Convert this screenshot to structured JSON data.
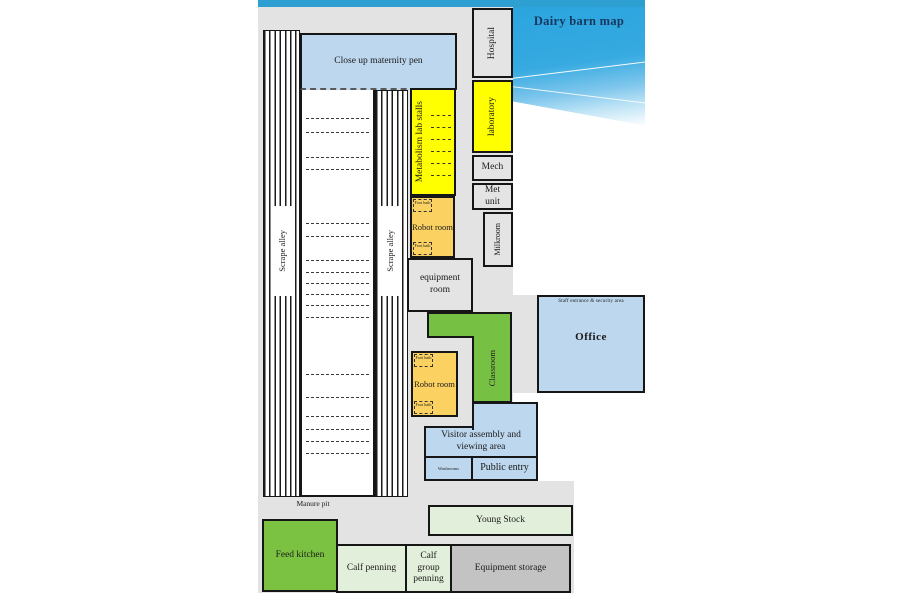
{
  "title": "Dairy barn map",
  "colors": {
    "header_bar": "#2d9fd0",
    "header_gradient": "#2ba4de",
    "title_text": "#17375e",
    "room_blue": "#bdd7ee",
    "room_yellow": "#ffff00",
    "room_orange": "#fbd262",
    "room_green": "#76c143",
    "room_pale_green": "#e2efda",
    "room_grey": "#e3e3e3",
    "room_dark_grey": "#c3c3c3"
  },
  "rooms": {
    "close_up_maternity_pen": "Close up maternity pen",
    "scrape_alley": "Scrape alley",
    "metabolism_lab_stalls": "Metabolism lab stalls",
    "hospital": "Hospital",
    "laboratory": "laboratory",
    "mech": "Mech",
    "met_unit": "Met unit",
    "milkroom": "Milkroom",
    "robot_room": "Robot room",
    "foot_bath": "Foot bath",
    "equipment_room": "equipment room",
    "classroom": "Classroom",
    "office": "Office",
    "staff_entrance": "Staff entrance & security area",
    "visitor_assembly": "Visitor assembly and viewing area",
    "washrooms": "Washrooms",
    "public_entry": "Public entry",
    "manure_pit": "Manure pit",
    "young_stock": "Young Stock",
    "feed_kitchen": "Feed kitchen",
    "calf_penning": "Calf penning",
    "calf_group_penning": "Calf group penning",
    "equipment_storage": "Equipment storage"
  }
}
